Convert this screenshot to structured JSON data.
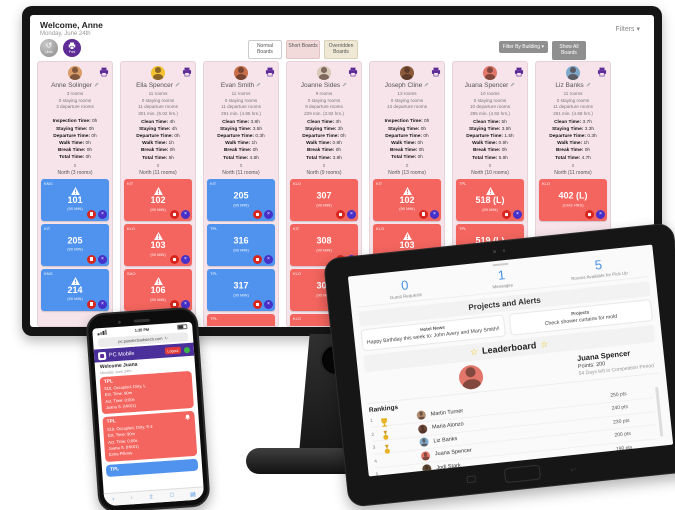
{
  "colors": {
    "accent_purple": "#5e2b97",
    "card_blue": "#4f93ee",
    "card_red": "#f4655f",
    "badge_red": "#d7261d",
    "badge_indigo": "#4630c8",
    "gold": "#e8b425",
    "stat_blue": "#4a90e2",
    "column_pink": "#f6e4ea",
    "phone_header_purple": "#4b2f9a",
    "logout_red": "#e23b3b",
    "online_green": "#3bb54a"
  },
  "icons": {
    "undo": "undo-arrow",
    "print": "printer",
    "edit": "pencil",
    "warning": "triangle-exclamation",
    "stop_badge": "white-square",
    "dnd_badge": "×",
    "filters_chevron": "▾",
    "star": "☆",
    "trophy": "trophy",
    "medal": "medal",
    "gift": "gift",
    "bell": "bell"
  },
  "desktop": {
    "header": {
      "welcome": "Welcome, Anne",
      "date": "Monday, June 24th",
      "filters": "Filters ▾",
      "undo": "Undo",
      "print": "Print"
    },
    "tabs": [
      {
        "label": "Normal Boards",
        "cls": "plain"
      },
      {
        "label": "Short Boards",
        "cls": "pink"
      },
      {
        "label": "Overridden Boards",
        "cls": "cream"
      }
    ],
    "filter_building": "Filter By Building ▾",
    "show_all": "Show All Boards",
    "columns": [
      {
        "name": "Anne Solinger",
        "avatar_color": "#d99c66",
        "rooms": "3 rooms",
        "staying": "0 staying rooms",
        "departure": "3 departure rooms",
        "minutes": "",
        "times": [
          {
            "label": "Inspection Time:",
            "value": "0h"
          },
          {
            "label": "Staying Time:",
            "value": "0h"
          },
          {
            "label": "Departure Time:",
            "value": "0h"
          },
          {
            "label": "Walk Time:",
            "value": "0h"
          },
          {
            "label": "Break Time:",
            "value": "0h"
          },
          {
            "label": "Total Time:",
            "value": "0h"
          }
        ],
        "counter": "0",
        "zone": "North (3 rooms)",
        "cards": [
          {
            "code": "KNG",
            "room": "101",
            "sub": "(90 MIN)",
            "color": "blue",
            "warn": true
          },
          {
            "code": "KIT",
            "room": "205",
            "sub": "(90 MIN)",
            "color": "blue",
            "warn": false
          },
          {
            "code": "KNG",
            "room": "214",
            "sub": "(90 MIN)",
            "color": "blue",
            "warn": true
          }
        ]
      },
      {
        "name": "Ella Spencer",
        "avatar_color": "#f2c230",
        "rooms": "11 rooms",
        "staying": "0 staying rooms",
        "departure": "11 departure rooms",
        "minutes": "301 min. (5.02 hrs.)",
        "times": [
          {
            "label": "Clean Time:",
            "value": "4h"
          },
          {
            "label": "Staying Time:",
            "value": "4h"
          },
          {
            "label": "Departure Time:",
            "value": "0h"
          },
          {
            "label": "Walk Time:",
            "value": "1h"
          },
          {
            "label": "Break Time:",
            "value": "0h"
          },
          {
            "label": "Total Time:",
            "value": "5h"
          }
        ],
        "counter": "0",
        "zone": "North (11 rooms)",
        "cards": [
          {
            "code": "KIT",
            "room": "102",
            "sub": "(90 MIN)",
            "color": "red",
            "warn": true
          },
          {
            "code": "KLO",
            "room": "103",
            "sub": "(90 MIN)",
            "color": "red",
            "warn": true
          },
          {
            "code": "SAO",
            "room": "106",
            "sub": "(90 MIN)",
            "color": "red",
            "warn": true
          },
          {
            "code": "SAO",
            "room": "107",
            "sub": "(90 MIN)",
            "color": "red",
            "warn": true
          }
        ]
      },
      {
        "name": "Evan Smith",
        "avatar_color": "#c96f4a",
        "rooms": "11 rooms",
        "staying": "0 staying rooms",
        "departure": "11 departure rooms",
        "minutes": "291 min. (4.85 hrs.)",
        "times": [
          {
            "label": "Clean Time:",
            "value": "3.8h"
          },
          {
            "label": "Staying Time:",
            "value": "3.5h"
          },
          {
            "label": "Departure Time:",
            "value": "0.3h"
          },
          {
            "label": "Walk Time:",
            "value": "1h"
          },
          {
            "label": "Break Time:",
            "value": "0h"
          },
          {
            "label": "Total Time:",
            "value": "4.8h"
          }
        ],
        "counter": "0",
        "zone": "North (11 rooms)",
        "cards": [
          {
            "code": "KIT",
            "room": "205",
            "sub": "(90 MIN)",
            "color": "blue",
            "warn": false
          },
          {
            "code": "TPL",
            "room": "316",
            "sub": "(90 MIN)",
            "color": "blue",
            "warn": false
          },
          {
            "code": "TPL",
            "room": "317",
            "sub": "(90 MIN)",
            "color": "blue",
            "warn": false
          },
          {
            "code": "TPL",
            "room": "318",
            "sub": "(90 MIN)",
            "color": "red",
            "warn": false
          }
        ]
      },
      {
        "name": "Joanne Sides",
        "avatar_color": "#d9c9b8",
        "rooms": "9 rooms",
        "staying": "0 staying rooms",
        "departure": "9 departure rooms",
        "minutes": "229 min. (3.82 hrs.)",
        "times": [
          {
            "label": "Clean Time:",
            "value": "3h"
          },
          {
            "label": "Staying Time:",
            "value": "3h"
          },
          {
            "label": "Departure Time:",
            "value": "0h"
          },
          {
            "label": "Walk Time:",
            "value": "0.8h"
          },
          {
            "label": "Break Time:",
            "value": "0h"
          },
          {
            "label": "Total Time:",
            "value": "3.8h"
          }
        ],
        "counter": "0",
        "zone": "North (9 rooms)",
        "cards": [
          {
            "code": "KLO",
            "room": "307",
            "sub": "(90 MIN)",
            "color": "red",
            "warn": false
          },
          {
            "code": "KIT",
            "room": "308",
            "sub": "(90 MIN)",
            "color": "red",
            "warn": false
          },
          {
            "code": "KLO",
            "room": "309",
            "sub": "(90 MIN)",
            "color": "red",
            "warn": false
          },
          {
            "code": "KLO",
            "room": "310",
            "sub": "(90 MIN)",
            "color": "red",
            "warn": false
          }
        ]
      },
      {
        "name": "Joseph Cline",
        "avatar_color": "#8a5a3a",
        "rooms": "13 rooms",
        "staying": "0 staying rooms",
        "departure": "13 departure rooms",
        "minutes": "",
        "times": [
          {
            "label": "Inspection Time:",
            "value": "0h"
          },
          {
            "label": "Staying Time:",
            "value": "0h"
          },
          {
            "label": "Departure Time:",
            "value": "0h"
          },
          {
            "label": "Walk Time:",
            "value": "0h"
          },
          {
            "label": "Break Time:",
            "value": "0h"
          },
          {
            "label": "Total Time:",
            "value": "0h"
          }
        ],
        "counter": "0",
        "zone": "North (13 rooms)",
        "cards": [
          {
            "code": "KIT",
            "room": "102",
            "sub": "(90 MIN)",
            "color": "red",
            "warn": true
          },
          {
            "code": "KLO",
            "room": "103",
            "sub": "(90 MIN)",
            "color": "red",
            "warn": true
          },
          {
            "code": "PVC",
            "room": "106",
            "sub": "(90 MIN)",
            "color": "red",
            "warn": true
          },
          {
            "code": "PVC",
            "room": "107",
            "sub": "(90 MIN)",
            "color": "red",
            "warn": true
          }
        ]
      },
      {
        "name": "Juana Spencer",
        "avatar_color": "#e2766a",
        "rooms": "10 rooms",
        "staying": "0 staying rooms",
        "departure": "10 departure rooms",
        "minutes": "295 min. (4.92 hrs.)",
        "times": [
          {
            "label": "Clean Time:",
            "value": "5h"
          },
          {
            "label": "Staying Time:",
            "value": "3.5h"
          },
          {
            "label": "Departure Time:",
            "value": "1.5h"
          },
          {
            "label": "Walk Time:",
            "value": "0.9h"
          },
          {
            "label": "Break Time:",
            "value": "0h"
          },
          {
            "label": "Total Time:",
            "value": "5.9h"
          }
        ],
        "counter": "0",
        "zone": "North (10 rooms)",
        "cards": [
          {
            "code": "TPL",
            "room": "518 (L)",
            "sub": "(90 MIN)",
            "color": "red",
            "warn": true
          },
          {
            "code": "TPL",
            "room": "519 (L)",
            "sub": "(90 MIN)",
            "color": "red",
            "warn": false
          },
          {
            "code": "TPL",
            "room": "520",
            "sub": "(90 MIN)",
            "color": "blue",
            "warn": false
          },
          {
            "code": "TPL",
            "room": "521",
            "sub": "(90 MIN)",
            "color": "red",
            "warn": false
          }
        ]
      },
      {
        "name": "Liz Banks",
        "avatar_color": "#7fa8c9",
        "rooms": "11 rooms",
        "staying": "0 staying rooms",
        "departure": "11 departure rooms",
        "minutes": "281 min. (4.68 hrs.)",
        "times": [
          {
            "label": "Clean Time:",
            "value": "3.7h"
          },
          {
            "label": "Staying Time:",
            "value": "3.3h"
          },
          {
            "label": "Departure Time:",
            "value": "0.3h"
          },
          {
            "label": "Walk Time:",
            "value": "1h"
          },
          {
            "label": "Break Time:",
            "value": "0h"
          },
          {
            "label": "Total Time:",
            "value": "4.7h"
          }
        ],
        "counter": "0",
        "zone": "North (11 rooms)",
        "cards": [
          {
            "code": "KLO",
            "room": "402 (L)",
            "sub": "(CHG HRS)",
            "color": "red",
            "warn": false
          }
        ]
      }
    ]
  },
  "phone": {
    "status_time": "1:25 PM",
    "url": "pc.purplecloudstech.com",
    "refresh": "↻",
    "brand": "PC Mobile",
    "logout": "Logout",
    "welcome": "Welcome Juana",
    "date": "Monday June 24th",
    "cards": [
      {
        "code": "TPL",
        "color": "red",
        "bell": false,
        "lines": [
          "518, Occupied, Dirty, L",
          "Est. Time: 90m",
          "Act. Time: 0:00s",
          "Juana S. (HK01)"
        ]
      },
      {
        "code": "TPL",
        "color": "red",
        "bell": true,
        "lines": [
          "519, Occupied, Dirty, S-2",
          "Est. Time: 90m",
          "Act. Time: 0:00s",
          "Juana S. (HK01)",
          "Extra Pillows"
        ]
      },
      {
        "code": "TPL",
        "color": "blue",
        "bell": false,
        "lines": []
      }
    ],
    "nav": [
      "‹",
      "›",
      "⇧",
      "□",
      "▤"
    ]
  },
  "tablet": {
    "stats": [
      {
        "value": "0",
        "label": "Guest Requests"
      },
      {
        "value": "1",
        "label": "Messages"
      },
      {
        "value": "5",
        "label": "Rooms Available for Pick Up"
      }
    ],
    "projects_alerts_title": "Projects and Alerts",
    "hotel_news": {
      "title": "Hotel News",
      "body": "Happy Birthday this week to: John Avery and Mary Smith!!"
    },
    "projects": {
      "title": "Projects",
      "body": "Check shower curtains for mold"
    },
    "leaderboard_title": "Leaderboard",
    "star": "☆",
    "profile": {
      "name": "Juana Spencer",
      "points": "Points: 200",
      "days": "54 Days left in Competition Period",
      "avatar_color": "#e2766a"
    },
    "rankings_title": "Rankings",
    "rankings": [
      {
        "rank": "1",
        "trophy": true,
        "name": "Martin Turner",
        "pts": "250 pts",
        "avatar_color": "#b08d6e"
      },
      {
        "rank": "2",
        "medal": true,
        "name": "Maria Alonzo",
        "pts": "240 pts",
        "avatar_color": "#6e4a3a"
      },
      {
        "rank": "3",
        "medal": true,
        "name": "Liz Banks",
        "pts": "230 pts",
        "avatar_color": "#7fa8c9"
      },
      {
        "rank": "4",
        "name": "Juana Spencer",
        "pts": "200 pts",
        "avatar_color": "#e2766a"
      },
      {
        "rank": "5",
        "name": "Jodi Stark",
        "pts": "190 pts",
        "avatar_color": "#5a4632"
      }
    ],
    "prizes_label": "Prizes"
  }
}
